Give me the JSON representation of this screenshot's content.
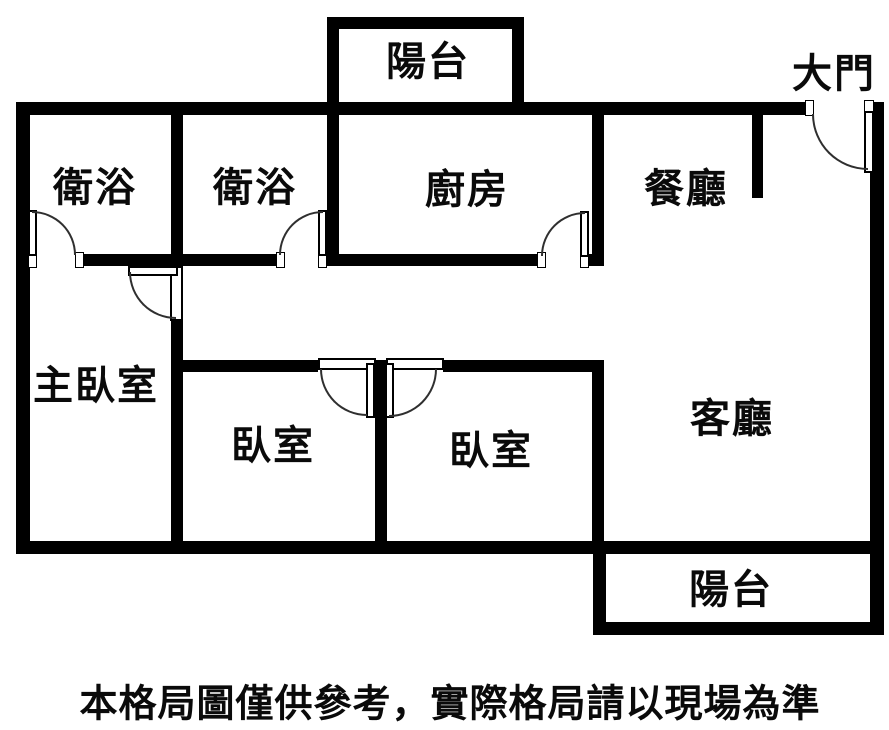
{
  "rooms": {
    "balcony_top": {
      "label": "陽台"
    },
    "entrance": {
      "label": "大門"
    },
    "bathroom_1": {
      "label": "衛浴"
    },
    "bathroom_2": {
      "label": "衛浴"
    },
    "kitchen": {
      "label": "廚房"
    },
    "dining_room": {
      "label": "餐廳"
    },
    "master_bedroom": {
      "label": "主臥室"
    },
    "bedroom_1": {
      "label": "臥室"
    },
    "bedroom_2": {
      "label": "臥室"
    },
    "living_room": {
      "label": "客廳"
    },
    "balcony_bottom": {
      "label": "陽台"
    }
  },
  "footer": {
    "disclaimer": "本格局圖僅供參考，實際格局請以現場為準"
  },
  "colors": {
    "wall": "#000000",
    "background": "#ffffff",
    "text": "#0a0a0a",
    "door_arc": "#2f2f2f"
  }
}
